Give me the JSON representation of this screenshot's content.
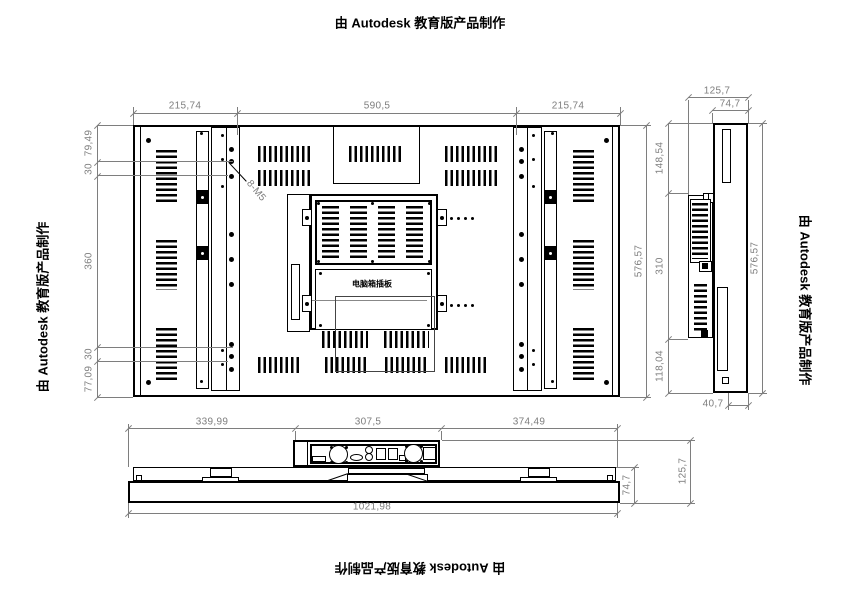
{
  "drawing": {
    "edge_labels": {
      "top": "由 Autodesk 教育版产品制作",
      "left": "由 Autodesk 教育版产品制作",
      "right": "由 Autodesk 教育版产品制作",
      "bottom": "由 Autodesk 教育版产品制作"
    }
  },
  "rear_view": {
    "dims": {
      "top_left": "215,74",
      "top_center": "590,5",
      "top_right": "215,74",
      "left_1": "79,49",
      "left_2": "30",
      "left_3": "360",
      "left_4": "30",
      "left_5": "77,09",
      "right_height": "576,57"
    },
    "annotations": {
      "bolt_callout": "8-M5",
      "pc_box_label": "电脑箱插板"
    }
  },
  "side_view": {
    "dims": {
      "top_outer": "125,7",
      "top_inner": "74,7",
      "left_1": "148,54",
      "left_2": "310",
      "left_3": "118,04",
      "right_height": "576,57",
      "bottom": "40,7"
    }
  },
  "bottom_view": {
    "dims": {
      "top_left": "339,99",
      "top_center": "307,5",
      "top_right": "374,49",
      "total_width": "1021,98",
      "right_inner": "74,7",
      "right_outer": "125,7"
    }
  },
  "colors": {
    "line": "#000000",
    "dimension": "#7e7e7e",
    "background": "#ffffff"
  }
}
